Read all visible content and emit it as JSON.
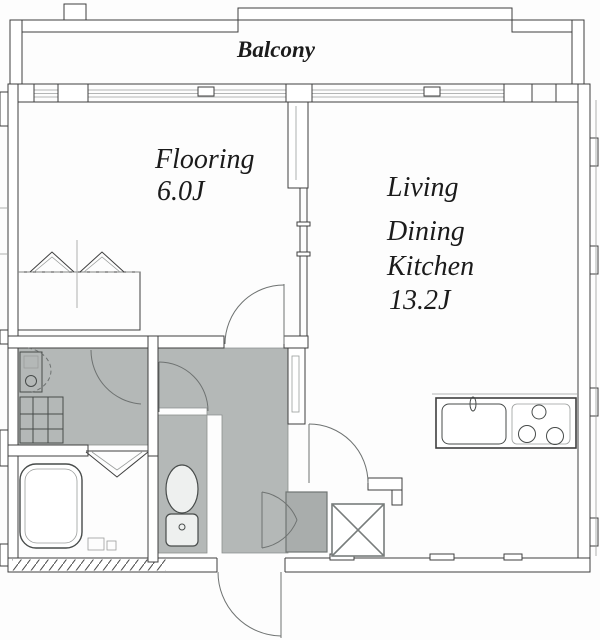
{
  "plan": {
    "type": "apartment-floor-plan",
    "labels": {
      "balcony": "Balcony",
      "flooring_name": "Flooring",
      "flooring_size": "6.0J",
      "ldk_line1": "Living",
      "ldk_line2": "Dining",
      "ldk_line3": "Kitchen",
      "ldk_size": "13.2J"
    },
    "colors": {
      "background": "#fdfdfd",
      "wall_line": "#3f3f3f",
      "floor_gray": "#b4b8b7",
      "entry_gray": "#a9adac",
      "shaft_line": "#787d7c",
      "text": "#1b1b1b"
    },
    "fixtures": [
      "bathtub",
      "toilet",
      "wash-basin",
      "washing-machine-pan",
      "kitchen-sink",
      "gas-stove",
      "pipe-shaft",
      "closet-bifold-doors",
      "entrance-double-cabinet",
      "entrance-door",
      "window-wall"
    ]
  }
}
